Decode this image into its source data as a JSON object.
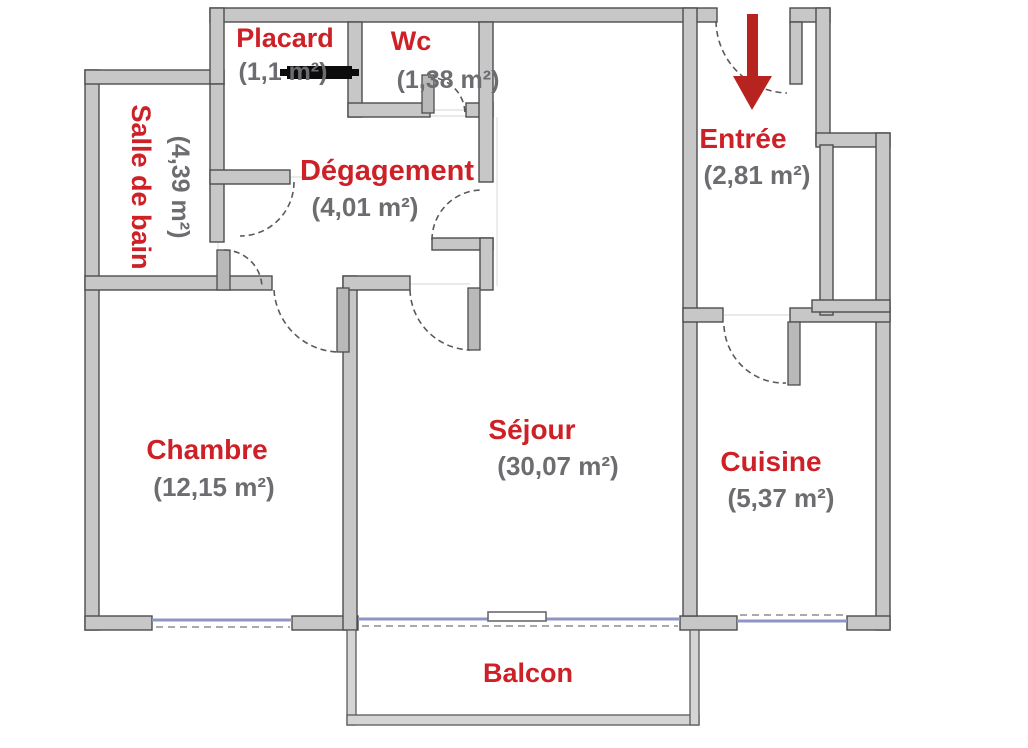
{
  "plan": {
    "title": "apartment-floor-plan",
    "rooms": {
      "placard": {
        "name": "Placard",
        "area": "(1,1 m²)"
      },
      "wc": {
        "name": "Wc",
        "area": "(1,38 m²)"
      },
      "salle_de_bain": {
        "name": "Salle de bain",
        "area": "(4,39 m²)"
      },
      "degagement": {
        "name": "Dégagement",
        "area": "(4,01 m²)"
      },
      "entree": {
        "name": "Entrée",
        "area": "(2,81 m²)"
      },
      "chambre": {
        "name": "Chambre",
        "area": "(12,15 m²)"
      },
      "sejour": {
        "name": "Séjour",
        "area": "(30,07 m²)"
      },
      "cuisine": {
        "name": "Cuisine",
        "area": "(5,37 m²)"
      },
      "balcon": {
        "name": "Balcon"
      }
    },
    "icons": {
      "entry_arrow": "entry-direction-arrow"
    },
    "colors": {
      "room_label": "#cd2127",
      "area_label": "#6d6d71",
      "wall_fill": "#c7c7c7",
      "wall_outline": "#4d4d4d",
      "balcony_wall": "#d5d5d5",
      "window_line": "#9096c3",
      "entry_arrow": "#b7241f",
      "closet_door_bar": "#0c0c0c"
    }
  }
}
